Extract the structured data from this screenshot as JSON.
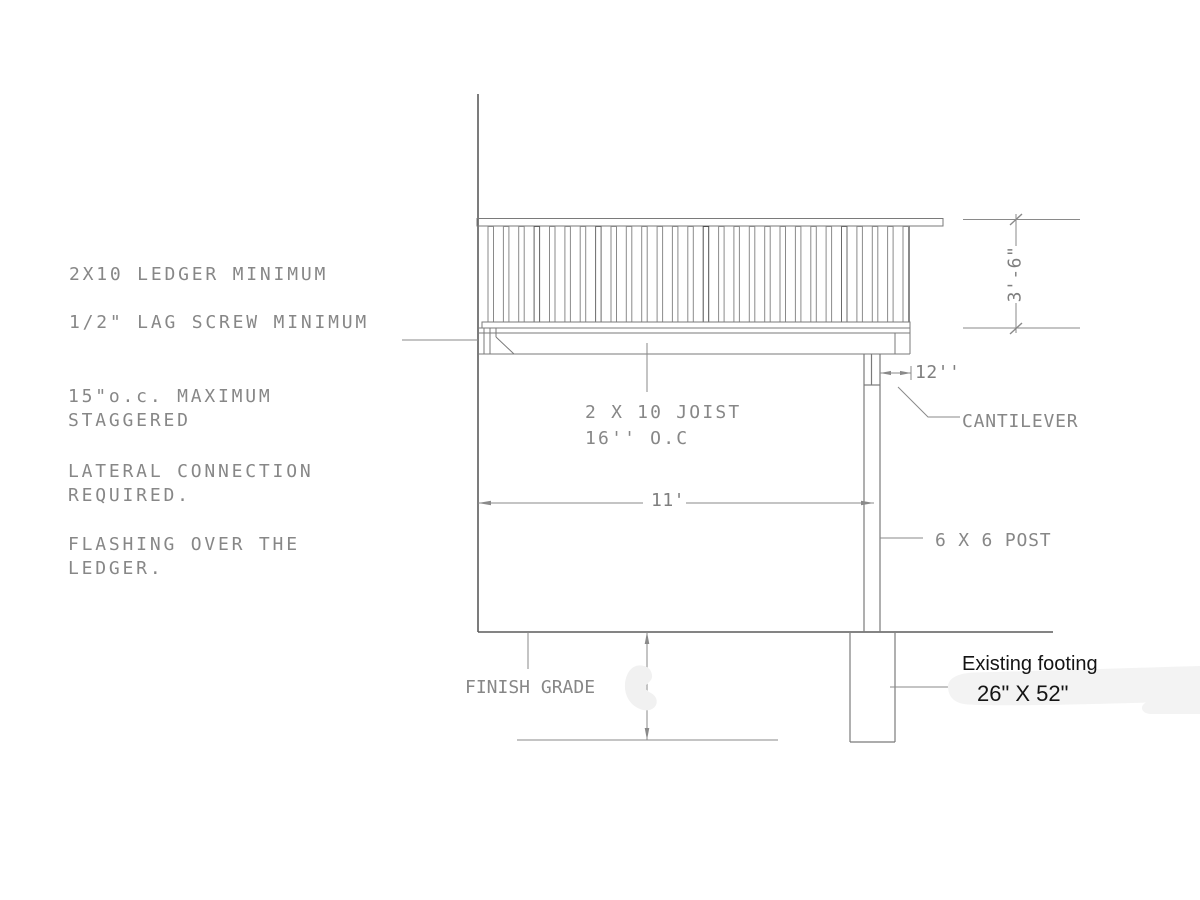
{
  "drawing": {
    "title_hint": "Deck ledger / cantilever section detail",
    "notes": {
      "ledger": "2X10 LEDGER MINIMUM",
      "lag_screw": "1/2\" LAG SCREW MINIMUM",
      "spacing_line1": "15\"o.c. MAXIMUM",
      "spacing_line2": "STAGGERED",
      "lateral_line1": "LATERAL CONNECTION",
      "lateral_line2": "REQUIRED.",
      "flashing_line1": "FLASHING OVER THE",
      "flashing_line2": "LEDGER."
    },
    "labels": {
      "joist_line1": "2 X 10 JOIST",
      "joist_line2": "16'' O.C",
      "cantilever": "CANTILEVER",
      "post": "6 X 6 POST",
      "finish_grade": "FINISH GRADE",
      "footing_title": "Existing footing",
      "footing_size": "26\" X 52\""
    },
    "dimensions": {
      "rail_height": "3'-6\"",
      "deck_span": "11'",
      "cantilever_length": "12''"
    },
    "colors": {
      "line": "#7a7a7a",
      "dark_line": "#5c5c5c",
      "cad_text": "#878787",
      "annotation_text": "#141414",
      "patch": "#f2f2f2"
    }
  }
}
